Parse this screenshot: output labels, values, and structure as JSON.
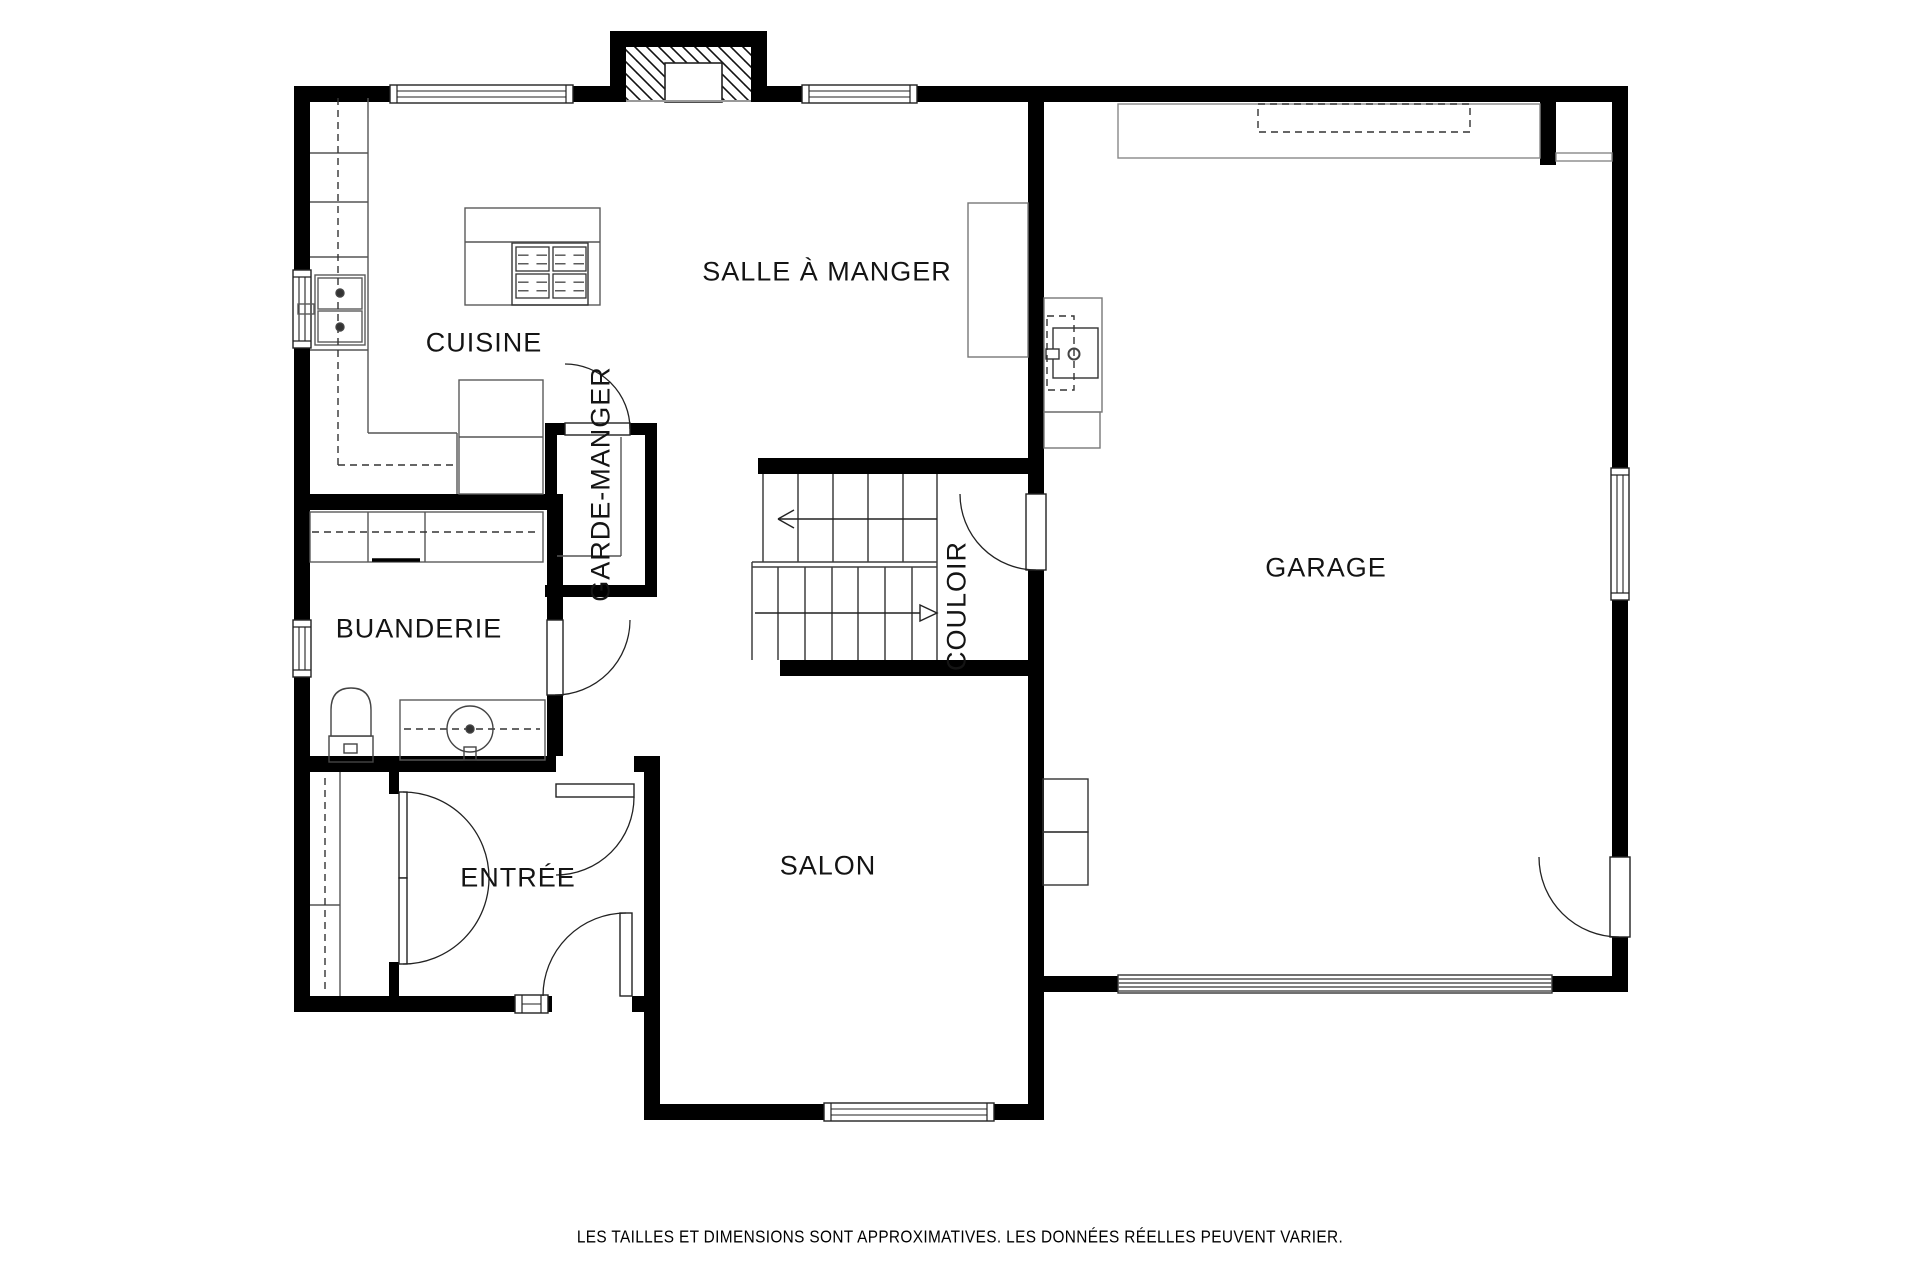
{
  "meta": {
    "disclaimer": "LES TAILLES ET DIMENSIONS SONT APPROXIMATIVES. LES DONNÉES RÉELLES PEUVENT VARIER.",
    "background": "#ffffff",
    "wall_color": "#000000",
    "fixture_color": "#5a5a5a",
    "frame_color": "#222222"
  },
  "rooms": [
    {
      "id": "cuisine",
      "label": "CUISINE",
      "x": 484,
      "y": 343,
      "rot": 0
    },
    {
      "id": "salle-a-manger",
      "label": "SALLE À MANGER",
      "x": 827,
      "y": 272,
      "rot": 0
    },
    {
      "id": "garde-manger",
      "label": "GARDE-MANGER",
      "x": 601,
      "y": 484,
      "rot": -90
    },
    {
      "id": "buanderie",
      "label": "BUANDERIE",
      "x": 419,
      "y": 629,
      "rot": 0
    },
    {
      "id": "couloir",
      "label": "COULOIR",
      "x": 957,
      "y": 606,
      "rot": -90
    },
    {
      "id": "garage",
      "label": "GARAGE",
      "x": 1326,
      "y": 568,
      "rot": 0
    },
    {
      "id": "entree",
      "label": "ENTRÉE",
      "x": 518,
      "y": 878,
      "rot": 0
    },
    {
      "id": "salon",
      "label": "SALON",
      "x": 828,
      "y": 866,
      "rot": 0
    }
  ],
  "plan": {
    "walls": [
      {
        "n": "wall-top",
        "x": 294,
        "y": 86,
        "w": 1334,
        "h": 16
      },
      {
        "n": "wall-left",
        "x": 294,
        "y": 86,
        "w": 16,
        "h": 926
      },
      {
        "n": "wall-right",
        "x": 1612,
        "y": 86,
        "w": 16,
        "h": 906
      },
      {
        "n": "wall-garage-bottom",
        "x": 1028,
        "y": 976,
        "w": 600,
        "h": 16
      },
      {
        "n": "wall-entree-bottom",
        "x": 294,
        "y": 996,
        "w": 366,
        "h": 16
      },
      {
        "n": "wall-entree-right",
        "x": 644,
        "y": 758,
        "w": 16,
        "h": 362
      },
      {
        "n": "wall-salon-bottom",
        "x": 644,
        "y": 1104,
        "w": 400,
        "h": 16
      },
      {
        "n": "wall-garage-divider",
        "x": 1028,
        "y": 102,
        "w": 16,
        "h": 1002
      },
      {
        "n": "wall-cuisine-buanderie",
        "x": 294,
        "y": 494,
        "w": 269,
        "h": 16
      },
      {
        "n": "wall-buanderie-right",
        "x": 547,
        "y": 510,
        "w": 16,
        "h": 262
      },
      {
        "n": "wall-buanderie-entree",
        "x": 294,
        "y": 756,
        "w": 366,
        "h": 16
      },
      {
        "n": "wall-gm-top",
        "x": 545,
        "y": 423,
        "w": 112,
        "h": 12
      },
      {
        "n": "wall-gm-left",
        "x": 545,
        "y": 423,
        "w": 12,
        "h": 87
      },
      {
        "n": "wall-gm-right",
        "x": 645,
        "y": 423,
        "w": 12,
        "h": 174
      },
      {
        "n": "wall-gm-bottom",
        "x": 545,
        "y": 585,
        "w": 112,
        "h": 12
      },
      {
        "n": "wall-stairs-top",
        "x": 758,
        "y": 458,
        "w": 270,
        "h": 16
      },
      {
        "n": "wall-stairs-bottom",
        "x": 780,
        "y": 660,
        "w": 248,
        "h": 16
      },
      {
        "n": "wall-closet-stub-top",
        "x": 389,
        "y": 756,
        "w": 10,
        "h": 38
      },
      {
        "n": "wall-closet-stub-bottom",
        "x": 389,
        "y": 962,
        "w": 10,
        "h": 50
      },
      {
        "n": "wall-garage-nook-stub",
        "x": 1540,
        "y": 102,
        "w": 16,
        "h": 63
      }
    ],
    "chimney": {
      "outer": {
        "x": 610,
        "y": 31,
        "w": 157,
        "h": 71
      },
      "hatch": {
        "x": 626,
        "y": 47,
        "w": 125,
        "h": 55
      },
      "flue": {
        "x": 665,
        "y": 63,
        "w": 57,
        "h": 39
      },
      "baseline": [
        626,
        101,
        751,
        101
      ]
    },
    "windows": [
      {
        "n": "window-cuisine-top",
        "x": 390,
        "y": 85,
        "w": 183,
        "h": 18,
        "o": "h",
        "panes": 2
      },
      {
        "n": "window-salle-top",
        "x": 802,
        "y": 85,
        "w": 115,
        "h": 18,
        "o": "h",
        "panes": 2
      },
      {
        "n": "window-cuisine-left",
        "x": 293,
        "y": 270,
        "w": 18,
        "h": 78,
        "o": "v",
        "panes": 2
      },
      {
        "n": "window-buanderie-left",
        "x": 293,
        "y": 620,
        "w": 18,
        "h": 57,
        "o": "v",
        "panes": 2
      },
      {
        "n": "window-garage-right",
        "x": 1611,
        "y": 468,
        "w": 18,
        "h": 132,
        "o": "v",
        "panes": 2
      },
      {
        "n": "window-salon-bottom",
        "x": 824,
        "y": 1103,
        "w": 170,
        "h": 18,
        "o": "h",
        "panes": 2
      },
      {
        "n": "window-entree-sidelight",
        "x": 515,
        "y": 995,
        "w": 33,
        "h": 18,
        "o": "h",
        "panes": 1
      }
    ],
    "doors": [
      {
        "n": "door-garde-manger",
        "gap": {
          "x": 565,
          "y": 423,
          "w": 65,
          "h": 12
        },
        "leaves": [
          {
            "x": 565,
            "y": 423,
            "w": 65,
            "h": 12
          }
        ],
        "arcs": [
          "M 565 364 A 65 65 0 0 1 630 429"
        ]
      },
      {
        "n": "door-buanderie",
        "gap": {
          "x": 547,
          "y": 620,
          "w": 16,
          "h": 75
        },
        "leaves": [
          {
            "x": 547,
            "y": 620,
            "w": 16,
            "h": 75
          }
        ],
        "arcs": [
          "M 630 620 A 75 75 0 0 1 555 695"
        ]
      },
      {
        "n": "door-entree-hall",
        "gap": {
          "x": 556,
          "y": 756,
          "w": 78,
          "h": 16
        },
        "leaves": [
          {
            "x": 556,
            "y": 784,
            "w": 78,
            "h": 13
          }
        ],
        "arcs": [
          "M 634 797 A 78 78 0 0 1 556 875"
        ]
      },
      {
        "n": "door-couloir-garage",
        "gap": {
          "x": 1028,
          "y": 494,
          "w": 16,
          "h": 76
        },
        "leaves": [
          {
            "x": 1026,
            "y": 494,
            "w": 20,
            "h": 76
          }
        ],
        "arcs": [
          "M 960 494 A 76 76 0 0 0 1036 570"
        ]
      },
      {
        "n": "door-garage-side",
        "gap": {
          "x": 1612,
          "y": 857,
          "w": 16,
          "h": 80
        },
        "leaves": [
          {
            "x": 1610,
            "y": 857,
            "w": 20,
            "h": 80
          }
        ],
        "arcs": [
          "M 1539 857 A 80 80 0 0 0 1619 937"
        ]
      },
      {
        "n": "door-entree-front",
        "gap": {
          "x": 552,
          "y": 996,
          "w": 80,
          "h": 16
        },
        "leaves": [
          {
            "x": 620,
            "y": 913,
            "w": 12,
            "h": 83
          }
        ],
        "arcs": [
          "M 626 913 A 83 83 0 0 0 543 996"
        ]
      },
      {
        "n": "closet-double-doors",
        "leaves": [
          {
            "x": 399,
            "y": 792,
            "w": 8,
            "h": 86
          },
          {
            "x": 399,
            "y": 878,
            "w": 8,
            "h": 86
          }
        ],
        "arcs": [
          "M 403 792 A 86 86 0 0 1 489 878",
          "M 489 878 A 86 86 0 0 1 403 964"
        ]
      }
    ],
    "stairs": {
      "lines": [
        [
          763,
          474,
          763,
          562
        ],
        [
          937,
          474,
          937,
          660
        ],
        [
          752,
          562,
          752,
          660
        ],
        [
          752,
          562,
          937,
          562
        ],
        [
          752,
          567,
          937,
          567
        ],
        [
          798,
          474,
          798,
          562
        ],
        [
          833,
          474,
          833,
          562
        ],
        [
          868,
          474,
          868,
          562
        ],
        [
          903,
          474,
          903,
          562
        ],
        [
          778,
          567,
          778,
          660
        ],
        [
          805,
          567,
          805,
          660
        ],
        [
          832,
          567,
          832,
          660
        ],
        [
          858,
          567,
          858,
          660
        ],
        [
          885,
          567,
          885,
          660
        ],
        [
          912,
          567,
          912,
          660
        ]
      ],
      "arrow_up": {
        "line": [
          778,
          519,
          937,
          519
        ],
        "head": [
          [
            778,
            519,
            794,
            510
          ],
          [
            778,
            519,
            794,
            528
          ]
        ]
      },
      "arrow_down": {
        "line": [
          755,
          613,
          920,
          613
        ],
        "tri": [
          [
            920,
            605
          ],
          [
            937,
            613
          ],
          [
            920,
            621
          ]
        ]
      }
    },
    "fixtures": {
      "rects": [
        {
          "n": "kitchen-sink-cabinet",
          "x": 315,
          "y": 275,
          "w": 50,
          "h": 70
        },
        {
          "n": "kitchen-sink-basin",
          "x": 318,
          "y": 278,
          "w": 44,
          "h": 31
        },
        {
          "n": "kitchen-sink-basin",
          "x": 318,
          "y": 311,
          "w": 44,
          "h": 31
        },
        {
          "n": "kitchen-faucet-box",
          "x": 298,
          "y": 304,
          "w": 16,
          "h": 10
        },
        {
          "n": "refrigerator",
          "x": 459,
          "y": 380,
          "w": 84,
          "h": 114
        },
        {
          "n": "kitchen-island",
          "x": 465,
          "y": 208,
          "w": 135,
          "h": 97
        },
        {
          "n": "stove",
          "x": 512,
          "y": 243,
          "w": 76,
          "h": 62,
          "s": "#333"
        },
        {
          "n": "laundry-counter",
          "x": 310,
          "y": 512,
          "w": 233,
          "h": 50
        },
        {
          "n": "laundry-sink-counter",
          "x": 400,
          "y": 700,
          "w": 145,
          "h": 60
        },
        {
          "n": "toilet-tank",
          "x": 329,
          "y": 736,
          "w": 44,
          "h": 26,
          "s": "#444"
        },
        {
          "n": "toilet-flush",
          "x": 344,
          "y": 744,
          "w": 13,
          "h": 9,
          "s": "#444"
        },
        {
          "n": "laundry-sink-drain",
          "x": 464,
          "y": 747,
          "w": 12,
          "h": 13,
          "s": "#444"
        },
        {
          "n": "garage-workbench",
          "x": 1118,
          "y": 104,
          "w": 422,
          "h": 54,
          "s": "#888"
        },
        {
          "n": "garage-nook-shelf",
          "x": 1556,
          "y": 153,
          "w": 56,
          "h": 8,
          "s": "#888"
        },
        {
          "n": "dining-sideboard",
          "x": 968,
          "y": 203,
          "w": 60,
          "h": 154,
          "s": "#777"
        },
        {
          "n": "garage-utility-sink-cabinet",
          "x": 1044,
          "y": 298,
          "w": 58,
          "h": 114,
          "s": "#777"
        },
        {
          "n": "garage-utility-base",
          "x": 1044,
          "y": 412,
          "w": 56,
          "h": 36,
          "s": "#777"
        },
        {
          "n": "garage-utility-sink",
          "x": 1053,
          "y": 328,
          "w": 45,
          "h": 50,
          "s": "#333"
        },
        {
          "n": "garage-utility-handle",
          "x": 1046,
          "y": 349,
          "w": 13,
          "h": 10,
          "s": "#333",
          "f": "#fff"
        },
        {
          "n": "garage-shelf-box",
          "x": 1043,
          "y": 779,
          "w": 45,
          "h": 53,
          "s": "#333"
        },
        {
          "n": "garage-shelf-box",
          "x": 1043,
          "y": 832,
          "w": 45,
          "h": 53,
          "s": "#333"
        },
        {
          "n": "garage-door",
          "x": 1118,
          "y": 975,
          "w": 434,
          "h": 18,
          "s": "#333",
          "f": "#fff"
        }
      ],
      "dashedRects": [
        {
          "n": "garage-dashed-zone",
          "x": 1258,
          "y": 104,
          "w": 212,
          "h": 28
        },
        {
          "n": "garage-utility-dashed",
          "x": 1047,
          "y": 316,
          "w": 27,
          "h": 74
        }
      ],
      "lines": [
        [
          368,
          98,
          368,
          433
        ],
        [
          368,
          433,
          457,
          433
        ],
        [
          457,
          433,
          457,
          494
        ],
        [
          310,
          153,
          368,
          153
        ],
        [
          310,
          202,
          368,
          202
        ],
        [
          310,
          257,
          368,
          257
        ],
        [
          310,
          350,
          368,
          350
        ],
        [
          459,
          437,
          543,
          437
        ],
        [
          465,
          242,
          600,
          242
        ],
        [
          368,
          512,
          368,
          562
        ],
        [
          425,
          512,
          425,
          562
        ],
        [
          340,
          772,
          340,
          996
        ],
        [
          310,
          905,
          340,
          905
        ],
        [
          621,
          437,
          621,
          556
        ],
        [
          557,
          556,
          621,
          556
        ],
        [
          1118,
          979,
          1552,
          979
        ],
        [
          1118,
          983,
          1552,
          983
        ],
        [
          1118,
          987,
          1552,
          987
        ],
        [
          1118,
          991,
          1552,
          991
        ]
      ],
      "dashedLines": [
        [
          338,
          98,
          338,
          465
        ],
        [
          338,
          465,
          455,
          465
        ],
        [
          312,
          532,
          540,
          532
        ],
        [
          404,
          729,
          540,
          729
        ],
        [
          325,
          778,
          325,
          992
        ]
      ],
      "thickLines": [
        [
          372,
          560,
          420,
          560
        ]
      ],
      "circles": [
        {
          "cx": 340,
          "cy": 293,
          "r": 4,
          "fill": true
        },
        {
          "cx": 340,
          "cy": 327,
          "r": 4,
          "fill": true
        },
        {
          "cx": 470,
          "cy": 729,
          "r": 23
        },
        {
          "cx": 470,
          "cy": 729,
          "r": 4,
          "fill": true
        },
        {
          "cx": 1074,
          "cy": 354,
          "r": 5.5,
          "sw": 2
        }
      ],
      "paths": [
        {
          "n": "toilet-bowl",
          "d": "M 331 736 L 331 710 Q 331 688 351 688 Q 371 688 371 710 L 371 736 Z",
          "s": "#444"
        }
      ],
      "burners": [
        {
          "x": 516,
          "y": 247,
          "w": 33,
          "h": 24
        },
        {
          "x": 553,
          "y": 247,
          "w": 33,
          "h": 24
        },
        {
          "x": 516,
          "y": 274,
          "w": 33,
          "h": 24
        },
        {
          "x": 553,
          "y": 274,
          "w": 33,
          "h": 24
        }
      ]
    }
  }
}
